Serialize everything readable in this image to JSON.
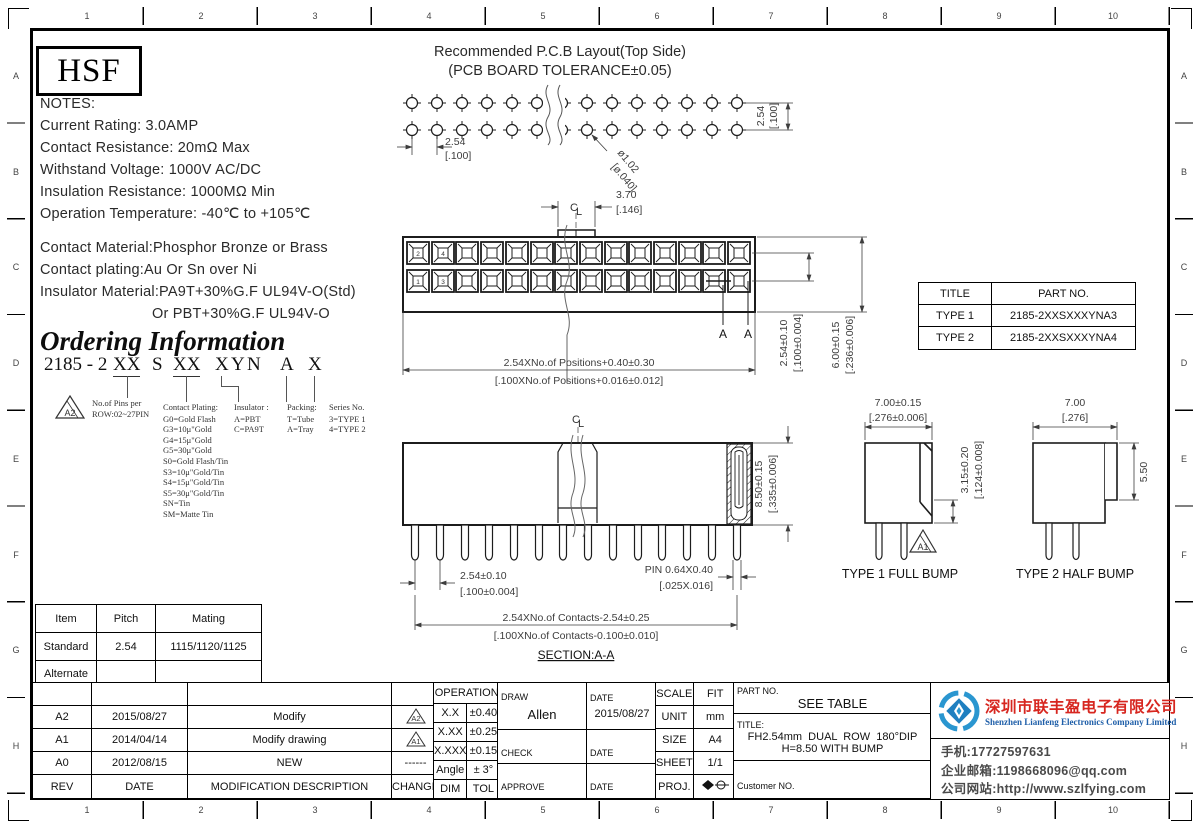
{
  "logo": "HSF",
  "ruler": {
    "cols": [
      "1",
      "2",
      "3",
      "4",
      "5",
      "6",
      "7",
      "8",
      "9",
      "10"
    ],
    "rows": [
      "A",
      "B",
      "C",
      "D",
      "E",
      "F",
      "G",
      "H"
    ]
  },
  "notes": {
    "title": "NOTES:",
    "line1": "Current Rating: 3.0AMP",
    "line2": "Contact Resistance: 20mΩ Max",
    "line3": "Withstand Voltage: 1000V AC/DC",
    "line4": "Insulation Resistance: 1000MΩ Min",
    "line5": "Operation Temperature: -40℃ to +105℃",
    "mat1": "Contact Material:Phosphor Bronze or Brass",
    "mat2": "Contact plating:Au Or Sn over Ni",
    "mat3": "Insulator Material:PA9T+30%G.F UL94V-O(Std)",
    "mat4": "Or PBT+30%G.F UL94V-O"
  },
  "ordering": {
    "title": "Ordering Information",
    "pn_prefix": "2185 - 2",
    "pn_pins": "XX",
    "pn_s": "S",
    "pn_plating": "XX",
    "pn_x": "X",
    "pn_y": "Y",
    "pn_n": "N",
    "pn_a": "A",
    "pn_series": "X",
    "flag": "A2",
    "pins_note1": "No.of Pins per",
    "pins_note2": "ROW:02~27PIN",
    "plating_title": "Contact Plating:",
    "plating1": "G0=Gold Flash",
    "plating2": "G3=10μ\"Gold",
    "plating3": "G4=15μ\"Gold",
    "plating4": "G5=30μ\"Gold",
    "plating5": "S0=Gold Flash/Tin",
    "plating6": "S3=10μ\"Gold/Tin",
    "plating7": "S4=15μ\"Gold/Tin",
    "plating8": "S5=30μ\"Gold/Tin",
    "plating9": "SN=Tin",
    "plating10": "SM=Matte Tin",
    "insulator_title": "Insulator :",
    "insulator1": "A=PBT",
    "insulator2": "C=PA9T",
    "packing_title": "Packing:",
    "packing1": "T=Tube",
    "packing2": "A=Tray",
    "series_title": "Series No.",
    "series1": "3=TYPE 1",
    "series2": "4=TYPE 2"
  },
  "centerline": {
    "c": "C",
    "l": "L"
  },
  "pcb": {
    "title1": "Recommended P.C.B Layout(Top Side)",
    "title2": "(PCB BOARD TOLERANCE±0.05)",
    "pitch_mm": "2.54",
    "pitch_in": "[.100]",
    "hole_mm": "ø1.02",
    "hole_in": "[ø.040]",
    "row_mm": "2.54",
    "row_in": "[.100]"
  },
  "front": {
    "tab_mm": "3.70",
    "tab_in": "[.146]",
    "pinA": "2",
    "pinB": "4",
    "pinC": "1",
    "pinD": "3",
    "width_mm": "2.54XNo.of Positions+0.40±0.30",
    "width_in": "[.100XNo.of Positions+0.016±0.012]",
    "row_mm": "2.54±0.10",
    "row_in": "[.100±0.004]",
    "height_mm": "6.00±0.15",
    "height_in": "[.236±0.006]",
    "section_a1": "A",
    "section_a2": "A"
  },
  "type_table": {
    "h1": "TITLE",
    "h2": "PART NO.",
    "r1c1": "TYPE 1",
    "r1c2": "2185-2XXSXXXYNA3",
    "r2c1": "TYPE 2",
    "r2c2": "2185-2XXSXXXYNA4"
  },
  "section": {
    "height_mm": "8.50±0.15",
    "height_in": "[.335±0.006]",
    "pitch_mm": "2.54±0.10",
    "pitch_in": "[.100±0.004]",
    "pin_mm": "PIN 0.64X0.40",
    "pin_in": "[.025X.016]",
    "span_mm": "2.54XNo.of Contacts-2.54±0.25",
    "span_in": "[.100XNo.of Contacts-0.100±0.010]",
    "label": "SECTION:A-A"
  },
  "type1": {
    "w_mm": "7.00±0.15",
    "w_in": "[.276±0.006]",
    "bump_mm": "3.15±0.20",
    "bump_in": "[.124±0.008]",
    "flag": "A1",
    "label": "TYPE 1 FULL BUMP"
  },
  "type2": {
    "w_mm": "7.00",
    "w_in": "[.276]",
    "bump": "5.50",
    "label": "TYPE 2 HALF BUMP"
  },
  "mating": {
    "h1": "Item",
    "h2": "Pitch",
    "h3": "Mating",
    "r1c1": "Standard",
    "r1c2": "2.54",
    "r1c3": "1115/1120/1125",
    "r2c1": "Alternate",
    "r2c2": "",
    "r2c3": ""
  },
  "revisions": {
    "hrev": "REV",
    "hdate": "DATE",
    "hdesc": "MODIFICATION DESCRIPTION",
    "hchange": "CHANGE",
    "r1rev": "A2",
    "r1date": "2015/08/27",
    "r1desc": "Modify",
    "r1flag": "A2",
    "r2rev": "A1",
    "r2date": "2014/04/14",
    "r2desc": "Modify drawing",
    "r2flag": "A1",
    "r3rev": "A0",
    "r3date": "2012/08/15",
    "r3desc": "NEW",
    "r3change": "------"
  },
  "tol": {
    "title": "OPERATION",
    "r1a": "X.X",
    "r1b": "±0.40",
    "r2a": "X.XX",
    "r2b": "±0.25",
    "r3a": "X.XXX",
    "r3b": "±0.15",
    "r4a": "Angle",
    "r4b": "± 3°",
    "r5a": "DIM",
    "r5b": "TOL"
  },
  "approval": {
    "draw": "DRAW",
    "draw_name": "Allen",
    "date1": "DATE",
    "draw_date": "2015/08/27",
    "check": "CHECK",
    "date2": "DATE",
    "approve": "APPROVE",
    "date3": "DATE"
  },
  "meta": {
    "scale": "SCALE",
    "scale_v": "FIT",
    "unit": "UNIT",
    "unit_v": "mm",
    "size": "SIZE",
    "size_v": "A4",
    "sheet": "SHEET",
    "sheet_v": "1/1",
    "proj": "PROJ."
  },
  "part_block": {
    "pn_label": "PART NO.",
    "pn": "SEE TABLE",
    "title_label": "TITLE:",
    "title1": "FH2.54mm  DUAL  ROW  180°DIP",
    "title2": "H=8.50 WITH BUMP",
    "customer": "Customer NO."
  },
  "company": {
    "cn": "深圳市联丰盈电子有限公司",
    "en": "Shenzhen Lianfeng Electronics Company Limited",
    "phone": "手机:17727597631",
    "email": "企业邮箱:1198668096@qq.com",
    "web": "公司网站:http://www.szlfying.com"
  }
}
